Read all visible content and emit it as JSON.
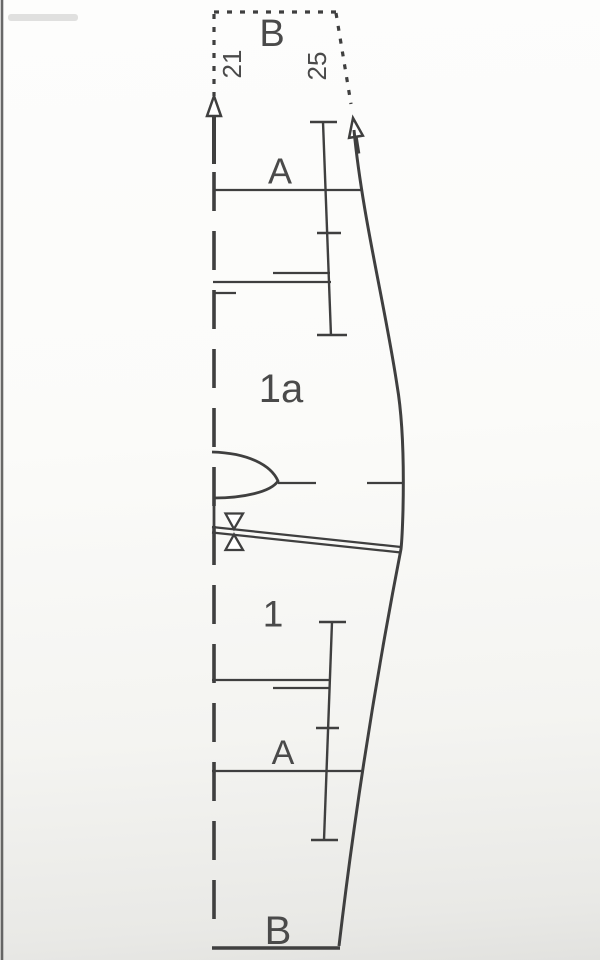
{
  "diagram": {
    "type": "sewing-pattern-piece",
    "labels": {
      "section_top": "B",
      "seam_length_left": "21",
      "seam_length_right": "25",
      "line_a_top": "A",
      "piece_upper": "1a",
      "piece_lower": "1",
      "line_a_bottom": "A",
      "section_bottom": "B"
    },
    "colors": {
      "line": "#3f3f3f",
      "text": "#4a4a4a",
      "background": "#fafaf8"
    }
  }
}
